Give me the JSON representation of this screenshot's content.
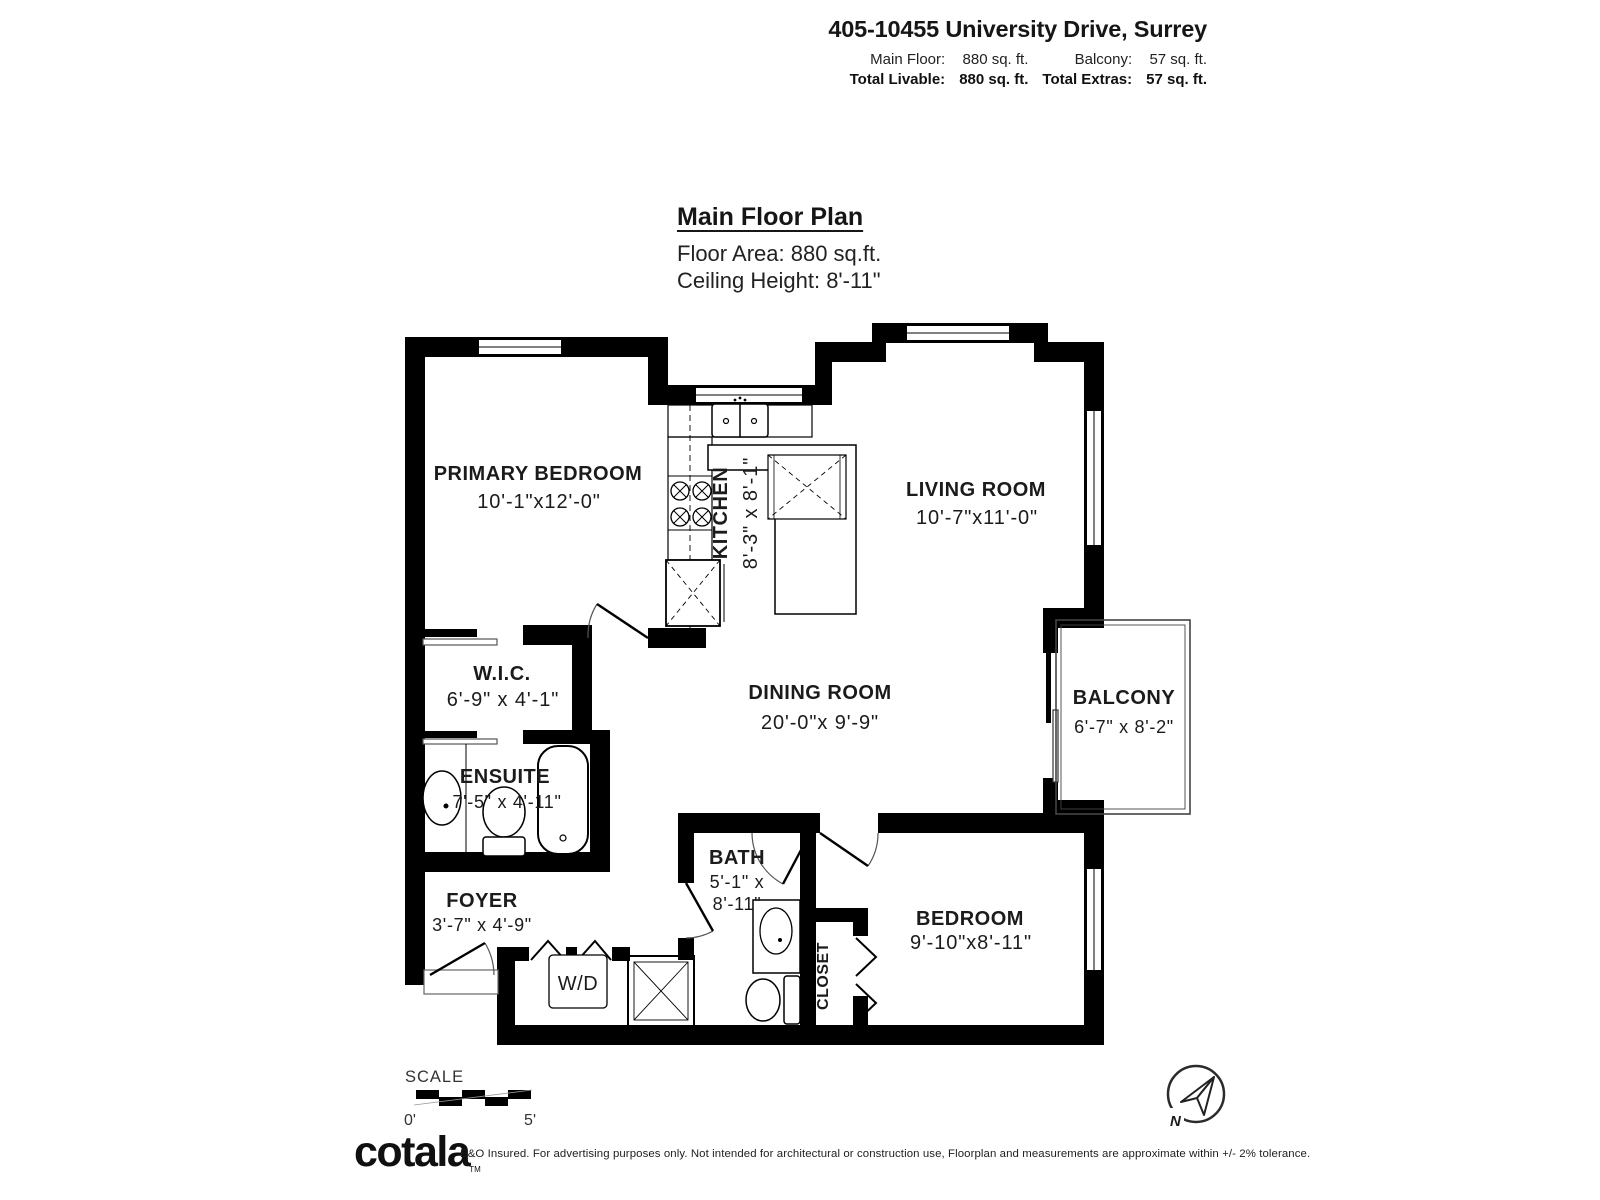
{
  "header": {
    "address": "405-10455 University Drive, Surrey",
    "stats": {
      "main_floor_label": "Main Floor:",
      "main_floor_value": "880 sq. ft.",
      "balcony_label": "Balcony:",
      "balcony_value": "57 sq. ft.",
      "total_livable_label": "Total Livable:",
      "total_livable_value": "880 sq. ft.",
      "total_extras_label": "Total Extras:",
      "total_extras_value": "57 sq. ft."
    }
  },
  "title_block": {
    "title": "Main Floor Plan",
    "floor_area": "Floor Area: 880 sq.ft.",
    "ceiling_height": "Ceiling Height: 8'-11\""
  },
  "rooms": {
    "primary_bedroom": {
      "name": "PRIMARY BEDROOM",
      "dims": "10'-1\"x12'-0\""
    },
    "kitchen": {
      "name": "KITCHEN",
      "dims": "8'-3\" x 8'-1\""
    },
    "living_room": {
      "name": "LIVING ROOM",
      "dims": "10'-7\"x11'-0\""
    },
    "wic": {
      "name": "W.I.C.",
      "dims": "6'-9\" x 4'-1\""
    },
    "dining_room": {
      "name": "DINING ROOM",
      "dims": "20'-0\"x 9'-9\""
    },
    "balcony": {
      "name": "BALCONY",
      "dims": "6'-7\" x 8'-2\""
    },
    "ensuite": {
      "name": "ENSUITE",
      "dims": "7'-5\" x 4'-11\""
    },
    "bath": {
      "name": "BATH",
      "dims_line1": "5'-1\" x",
      "dims_line2": "8'-11\""
    },
    "foyer": {
      "name": "FOYER",
      "dims": "3'-7\" x 4'-9\""
    },
    "bedroom": {
      "name": "BEDROOM",
      "dims": "9'-10\"x8'-11\""
    },
    "closet": {
      "name": "CLOSET"
    },
    "washer_dryer": {
      "name": "W/D"
    }
  },
  "scale_bar": {
    "label": "SCALE",
    "start": "0'",
    "end": "5'"
  },
  "compass": {
    "north": "N"
  },
  "footer": {
    "logo": "cotala",
    "tm": "TM",
    "disclaimer": "E&O Insured. For advertising purposes only. Not intended for architectural or construction use, Floorplan and measurements are approximate within +/- 2% tolerance."
  }
}
